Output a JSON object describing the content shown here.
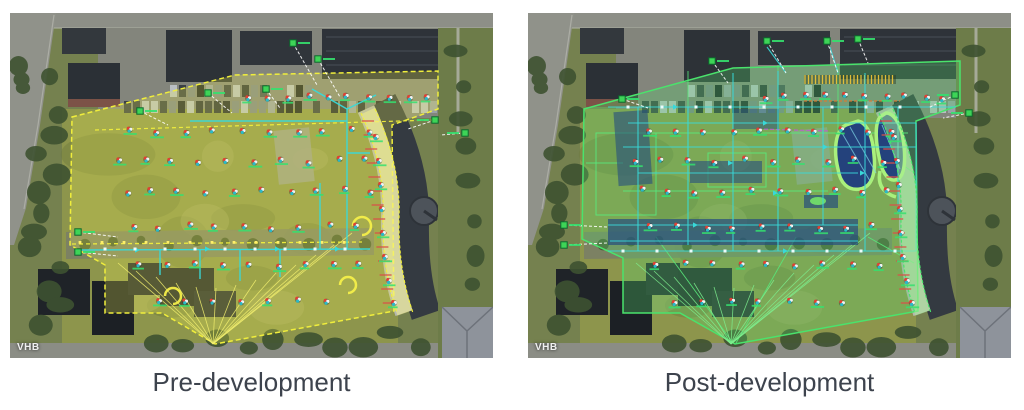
{
  "figure": {
    "background": "#ffffff",
    "caption_color": "#3d434d",
    "panels": [
      {
        "id": "pre-development",
        "caption": "Pre-development",
        "watermark": "VHB",
        "stage": "pre",
        "icons": [
          "runoff-marker-icon",
          "outfall-node-icon",
          "junction-node-icon"
        ],
        "theme": {
          "boundary_color": "#f0ee3c",
          "boundary_fill": "rgba(238,238,80,0.26)",
          "pipe_color": "#38d9d9",
          "drainage_line_color": "#f2ee6e",
          "node_color": "#ffef6a",
          "outfall_color": "#3ed457",
          "marker_red": "#e04034",
          "marker_teal": "#2ab9c9",
          "label_color": "#35e06e",
          "curve_band_fill": "rgba(248,244,140,0.5)"
        }
      },
      {
        "id": "post-development",
        "caption": "Post-development",
        "watermark": "VHB",
        "stage": "post",
        "icons": [
          "runoff-marker-icon",
          "outfall-node-icon",
          "junction-node-icon",
          "pond-outline-icon"
        ],
        "theme": {
          "boundary_color": "#4ae36c",
          "boundary_fill": "rgba(86,214,110,0.30)",
          "pipe_color": "#38d9d9",
          "drainage_line_color": "#7ef08e",
          "node_color": "#aef07e",
          "outfall_color": "#3ed457",
          "marker_red": "#e04034",
          "marker_teal": "#2ab9c9",
          "label_color": "#35e06e",
          "curve_band_fill": "rgba(168,240,150,0.5)",
          "pond_fill": "#24427c",
          "pond_outline": "#a9f07c",
          "water_fill": "#274f7e",
          "hatch_color": "#e8c23a",
          "accent_orange": "#e07830",
          "accent_magenta": "#c05ad0"
        }
      }
    ]
  }
}
